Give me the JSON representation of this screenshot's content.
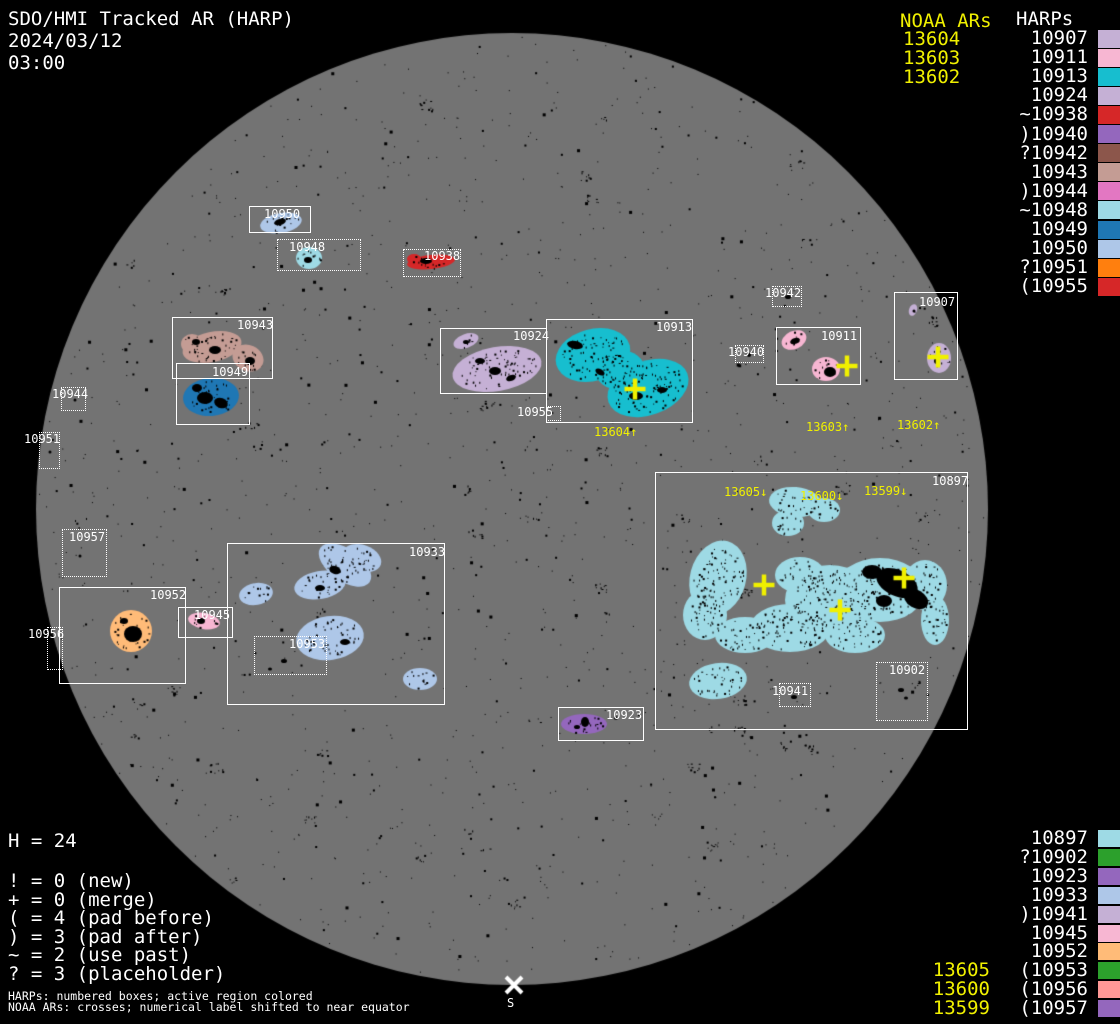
{
  "header": {
    "title": "SDO/HMI Tracked AR (HARP)",
    "date": "2024/03/12",
    "time": "03:00"
  },
  "colors": {
    "background": "#000000",
    "disk": "#737373",
    "yellow": "#f0f000",
    "white": "#ffffff"
  },
  "legend_top": {
    "noaa_title": "NOAA ARs",
    "harps_title": "HARPs",
    "noaa_items": [
      "13604",
      "13603",
      "13602"
    ],
    "harp_items": [
      {
        "label": "10907",
        "color": "#c5b0d5"
      },
      {
        "label": "10911",
        "color": "#f7b6d2"
      },
      {
        "label": "10913",
        "color": "#17becf"
      },
      {
        "label": "10924",
        "color": "#c5b0d5"
      },
      {
        "label": "~10938",
        "color": "#d62728"
      },
      {
        "label": ")10940",
        "color": "#9467bd"
      },
      {
        "label": "?10942",
        "color": "#8c564b"
      },
      {
        "label": "10943",
        "color": "#c49c94"
      },
      {
        "label": ")10944",
        "color": "#e377c2"
      },
      {
        "label": "~10948",
        "color": "#9edae5"
      },
      {
        "label": "10949",
        "color": "#1f77b4"
      },
      {
        "label": "10950",
        "color": "#aec7e8"
      },
      {
        "label": "?10951",
        "color": "#ff7f0e"
      },
      {
        "label": "(10955",
        "color": "#d62728"
      }
    ]
  },
  "legend_bottom": {
    "harp_items": [
      {
        "label": "10897",
        "color": "#9edae5",
        "noaa": ""
      },
      {
        "label": "?10902",
        "color": "#2ca02c",
        "noaa": ""
      },
      {
        "label": "10923",
        "color": "#9467bd",
        "noaa": ""
      },
      {
        "label": "10933",
        "color": "#aec7e8",
        "noaa": ""
      },
      {
        "label": ")10941",
        "color": "#c5b0d5",
        "noaa": ""
      },
      {
        "label": "10945",
        "color": "#f7b6d2",
        "noaa": ""
      },
      {
        "label": "10952",
        "color": "#ffbb78",
        "noaa": ""
      },
      {
        "label": "(10953",
        "color": "#2ca02c",
        "noaa": "13605"
      },
      {
        "label": "(10956",
        "color": "#ff9896",
        "noaa": "13600"
      },
      {
        "label": "(10957",
        "color": "#9467bd",
        "noaa": "13599"
      }
    ]
  },
  "stats": {
    "h_count": "H = 24",
    "flags": [
      "! = 0 (new)",
      "+ = 0 (merge)",
      "( = 4 (pad before)",
      ") = 3 (pad after)",
      "~ = 2 (use past)",
      "? = 3 (placeholder)"
    ]
  },
  "footnotes": [
    "HARPs: numbered boxes; active region colored",
    "NOAA ARs: crosses; numerical label shifted to near equator"
  ],
  "south_marker": {
    "symbol": "S",
    "x": 514,
    "y": 985
  },
  "disk": {
    "cx": 512,
    "cy": 509,
    "r": 476
  },
  "harp_boxes": [
    {
      "harp": "10950",
      "x": 249,
      "y": 206,
      "w": 62,
      "h": 27,
      "style": "solid",
      "label_x": 264,
      "label_y": 208
    },
    {
      "harp": "10948",
      "x": 277,
      "y": 239,
      "w": 84,
      "h": 32,
      "style": "dotted",
      "label_x": 289,
      "label_y": 241
    },
    {
      "harp": "10938",
      "x": 403,
      "y": 249,
      "w": 58,
      "h": 28,
      "style": "dotted",
      "label_x": 424,
      "label_y": 250
    },
    {
      "harp": "10943",
      "x": 172,
      "y": 317,
      "w": 101,
      "h": 62,
      "style": "solid",
      "label_x": 237,
      "label_y": 319
    },
    {
      "harp": "10949",
      "x": 176,
      "y": 363,
      "w": 74,
      "h": 62,
      "style": "solid",
      "label_x": 212,
      "label_y": 366
    },
    {
      "harp": "10944",
      "x": 61,
      "y": 387,
      "w": 25,
      "h": 24,
      "style": "dotted",
      "label_x": 52,
      "label_y": 388
    },
    {
      "harp": "10951",
      "x": 39,
      "y": 432,
      "w": 21,
      "h": 37,
      "style": "dotted",
      "label_x": 24,
      "label_y": 433
    },
    {
      "harp": "10942",
      "x": 772,
      "y": 286,
      "w": 30,
      "h": 21,
      "style": "dotted",
      "label_x": 765,
      "label_y": 287
    },
    {
      "harp": "10924",
      "x": 440,
      "y": 328,
      "w": 107,
      "h": 66,
      "style": "solid",
      "label_x": 513,
      "label_y": 330
    },
    {
      "harp": "10913",
      "x": 546,
      "y": 319,
      "w": 147,
      "h": 104,
      "style": "solid",
      "label_x": 656,
      "label_y": 321
    },
    {
      "harp": "10955",
      "x": 546,
      "y": 406,
      "w": 15,
      "h": 15,
      "style": "dotted",
      "label_x": 517,
      "label_y": 406
    },
    {
      "harp": "10940",
      "x": 735,
      "y": 345,
      "w": 29,
      "h": 18,
      "style": "dotted",
      "label_x": 728,
      "label_y": 346
    },
    {
      "harp": "10911",
      "x": 776,
      "y": 327,
      "w": 85,
      "h": 58,
      "style": "solid",
      "label_x": 821,
      "label_y": 330
    },
    {
      "harp": "10907",
      "x": 894,
      "y": 292,
      "w": 64,
      "h": 88,
      "style": "solid",
      "label_x": 919,
      "label_y": 296
    },
    {
      "harp": "10957",
      "x": 62,
      "y": 529,
      "w": 45,
      "h": 48,
      "style": "dotted",
      "label_x": 69,
      "label_y": 531
    },
    {
      "harp": "10952",
      "x": 59,
      "y": 587,
      "w": 127,
      "h": 97,
      "style": "solid",
      "label_x": 150,
      "label_y": 589
    },
    {
      "harp": "10945",
      "x": 178,
      "y": 607,
      "w": 55,
      "h": 31,
      "style": "solid",
      "label_x": 194,
      "label_y": 609
    },
    {
      "harp": "10956",
      "x": 47,
      "y": 627,
      "w": 16,
      "h": 43,
      "style": "dotted",
      "label_x": 28,
      "label_y": 628
    },
    {
      "harp": "10933",
      "x": 227,
      "y": 543,
      "w": 218,
      "h": 162,
      "style": "solid",
      "label_x": 409,
      "label_y": 546
    },
    {
      "harp": "10953",
      "x": 254,
      "y": 636,
      "w": 73,
      "h": 39,
      "style": "dotted",
      "label_x": 289,
      "label_y": 638
    },
    {
      "harp": "10923",
      "x": 558,
      "y": 707,
      "w": 86,
      "h": 34,
      "style": "solid",
      "label_x": 606,
      "label_y": 709
    },
    {
      "harp": "10897",
      "x": 655,
      "y": 472,
      "w": 313,
      "h": 258,
      "style": "solid",
      "label_x": 932,
      "label_y": 475
    },
    {
      "harp": "10941",
      "x": 779,
      "y": 683,
      "w": 32,
      "h": 24,
      "style": "dotted",
      "label_x": 772,
      "label_y": 685
    },
    {
      "harp": "10902",
      "x": 876,
      "y": 662,
      "w": 52,
      "h": 59,
      "style": "dotted",
      "label_x": 889,
      "label_y": 664
    }
  ],
  "noaa_labels": [
    {
      "text": "13604↑",
      "x": 594,
      "y": 426
    },
    {
      "text": "13603↑",
      "x": 806,
      "y": 421
    },
    {
      "text": "13602↑",
      "x": 897,
      "y": 419
    },
    {
      "text": "13605↓",
      "x": 724,
      "y": 486
    },
    {
      "text": "13600↓",
      "x": 800,
      "y": 490
    },
    {
      "text": "13599↓",
      "x": 864,
      "y": 485
    }
  ],
  "noaa_crosses": [
    {
      "x": 635,
      "y": 389
    },
    {
      "x": 847,
      "y": 366
    },
    {
      "x": 938,
      "y": 357
    },
    {
      "x": 764,
      "y": 585
    },
    {
      "x": 840,
      "y": 610
    },
    {
      "x": 904,
      "y": 578
    }
  ],
  "regions": [
    {
      "harp": "10950",
      "color": "#aec7e8",
      "ellipses": [
        {
          "cx": 281,
          "cy": 223,
          "rx": 21,
          "ry": 10,
          "rot": -10
        }
      ]
    },
    {
      "harp": "10948",
      "color": "#9edae5",
      "ellipses": [
        {
          "cx": 309,
          "cy": 258,
          "rx": 13,
          "ry": 11,
          "rot": 0
        }
      ]
    },
    {
      "harp": "10938",
      "color": "#d62728",
      "ellipses": [
        {
          "cx": 431,
          "cy": 262,
          "rx": 24,
          "ry": 7,
          "rot": -6
        },
        {
          "cx": 414,
          "cy": 259,
          "rx": 7,
          "ry": 5,
          "rot": 0
        }
      ]
    },
    {
      "harp": "10943",
      "color": "#c49c94",
      "ellipses": [
        {
          "cx": 212,
          "cy": 347,
          "rx": 30,
          "ry": 15,
          "rot": -12
        },
        {
          "cx": 248,
          "cy": 358,
          "rx": 16,
          "ry": 13,
          "rot": 25
        },
        {
          "cx": 192,
          "cy": 344,
          "rx": 11,
          "ry": 10,
          "rot": 0
        }
      ]
    },
    {
      "harp": "10949",
      "color": "#1f77b4",
      "ellipses": [
        {
          "cx": 211,
          "cy": 397,
          "rx": 28,
          "ry": 19,
          "rot": -5
        }
      ]
    },
    {
      "harp": "10924",
      "color": "#c5b0d5",
      "ellipses": [
        {
          "cx": 466,
          "cy": 341,
          "rx": 13,
          "ry": 7,
          "rot": -20
        },
        {
          "cx": 497,
          "cy": 369,
          "rx": 45,
          "ry": 22,
          "rot": -10
        }
      ]
    },
    {
      "harp": "10913",
      "color": "#17becf",
      "ellipses": [
        {
          "cx": 593,
          "cy": 355,
          "rx": 38,
          "ry": 26,
          "rot": -15
        },
        {
          "cx": 648,
          "cy": 388,
          "rx": 42,
          "ry": 27,
          "rot": -20
        },
        {
          "cx": 620,
          "cy": 370,
          "rx": 25,
          "ry": 20,
          "rot": 0
        }
      ]
    },
    {
      "harp": "10911",
      "color": "#f7b6d2",
      "ellipses": [
        {
          "cx": 794,
          "cy": 340,
          "rx": 13,
          "ry": 9,
          "rot": -25
        },
        {
          "cx": 826,
          "cy": 369,
          "rx": 14,
          "ry": 12,
          "rot": 0
        }
      ]
    },
    {
      "harp": "10907",
      "color": "#c5b0d5",
      "ellipses": [
        {
          "cx": 913,
          "cy": 310,
          "rx": 4,
          "ry": 6,
          "rot": 20
        },
        {
          "cx": 939,
          "cy": 358,
          "rx": 12,
          "ry": 15,
          "rot": 0
        }
      ]
    },
    {
      "harp": "10952",
      "color": "#ffbb78",
      "ellipses": [
        {
          "cx": 131,
          "cy": 631,
          "rx": 21,
          "ry": 21,
          "rot": 0
        }
      ]
    },
    {
      "harp": "10945",
      "color": "#f7b6d2",
      "ellipses": [
        {
          "cx": 204,
          "cy": 621,
          "rx": 16,
          "ry": 8,
          "rot": 10
        }
      ]
    },
    {
      "harp": "10933",
      "color": "#aec7e8",
      "ellipses": [
        {
          "cx": 256,
          "cy": 594,
          "rx": 17,
          "ry": 11,
          "rot": -10
        },
        {
          "cx": 345,
          "cy": 565,
          "rx": 30,
          "ry": 16,
          "rot": 35
        },
        {
          "cx": 320,
          "cy": 585,
          "rx": 26,
          "ry": 14,
          "rot": -10
        },
        {
          "cx": 362,
          "cy": 558,
          "rx": 20,
          "ry": 13,
          "rot": 20
        },
        {
          "cx": 330,
          "cy": 638,
          "rx": 34,
          "ry": 22,
          "rot": -8
        },
        {
          "cx": 420,
          "cy": 679,
          "rx": 17,
          "ry": 11,
          "rot": 0
        }
      ]
    },
    {
      "harp": "10923",
      "color": "#9467bd",
      "ellipses": [
        {
          "cx": 584,
          "cy": 724,
          "rx": 23,
          "ry": 10,
          "rot": 0
        }
      ]
    },
    {
      "harp": "10897",
      "color": "#9edae5",
      "ellipses": [
        {
          "cx": 795,
          "cy": 502,
          "rx": 26,
          "ry": 15,
          "rot": 5
        },
        {
          "cx": 788,
          "cy": 523,
          "rx": 16,
          "ry": 13,
          "rot": 0
        },
        {
          "cx": 824,
          "cy": 510,
          "rx": 16,
          "ry": 12,
          "rot": 0
        },
        {
          "cx": 718,
          "cy": 578,
          "rx": 28,
          "ry": 38,
          "rot": 15
        },
        {
          "cx": 705,
          "cy": 615,
          "rx": 22,
          "ry": 25,
          "rot": 0
        },
        {
          "cx": 745,
          "cy": 635,
          "rx": 30,
          "ry": 18,
          "rot": 0
        },
        {
          "cx": 790,
          "cy": 628,
          "rx": 40,
          "ry": 24,
          "rot": 0
        },
        {
          "cx": 800,
          "cy": 575,
          "rx": 25,
          "ry": 18,
          "rot": 0
        },
        {
          "cx": 830,
          "cy": 600,
          "rx": 45,
          "ry": 35,
          "rot": 0
        },
        {
          "cx": 880,
          "cy": 590,
          "rx": 45,
          "ry": 32,
          "rot": 0
        },
        {
          "cx": 855,
          "cy": 635,
          "rx": 30,
          "ry": 18,
          "rot": 0
        },
        {
          "cx": 925,
          "cy": 585,
          "rx": 22,
          "ry": 25,
          "rot": 0
        },
        {
          "cx": 935,
          "cy": 620,
          "rx": 14,
          "ry": 25,
          "rot": 0
        },
        {
          "cx": 718,
          "cy": 681,
          "rx": 29,
          "ry": 18,
          "rot": -8
        }
      ]
    }
  ],
  "dark_patches": [
    {
      "cx": 897,
      "cy": 583,
      "rx": 22,
      "ry": 13,
      "rot": 25
    },
    {
      "cx": 872,
      "cy": 572,
      "rx": 10,
      "ry": 7,
      "rot": 0
    },
    {
      "cx": 916,
      "cy": 599,
      "rx": 13,
      "ry": 9,
      "rot": 30
    },
    {
      "cx": 884,
      "cy": 601,
      "rx": 8,
      "ry": 6,
      "rot": 0
    },
    {
      "cx": 205,
      "cy": 398,
      "rx": 8,
      "ry": 6,
      "rot": 0
    },
    {
      "cx": 221,
      "cy": 403,
      "rx": 7,
      "ry": 5,
      "rot": 20
    },
    {
      "cx": 197,
      "cy": 388,
      "rx": 5,
      "ry": 4,
      "rot": 0
    },
    {
      "cx": 133,
      "cy": 634,
      "rx": 9,
      "ry": 8,
      "rot": 0
    },
    {
      "cx": 124,
      "cy": 621,
      "rx": 4,
      "ry": 3,
      "rot": 0
    },
    {
      "cx": 575,
      "cy": 345,
      "rx": 8,
      "ry": 4,
      "rot": 10
    },
    {
      "cx": 636,
      "cy": 396,
      "rx": 7,
      "ry": 4,
      "rot": 0
    },
    {
      "cx": 662,
      "cy": 390,
      "rx": 5,
      "ry": 3,
      "rot": 0
    },
    {
      "cx": 600,
      "cy": 372,
      "rx": 5,
      "ry": 3,
      "rot": 30
    },
    {
      "cx": 335,
      "cy": 570,
      "rx": 6,
      "ry": 4,
      "rot": 20
    },
    {
      "cx": 320,
      "cy": 588,
      "rx": 5,
      "ry": 3,
      "rot": 0
    },
    {
      "cx": 345,
      "cy": 642,
      "rx": 5,
      "ry": 3,
      "rot": 0
    },
    {
      "cx": 585,
      "cy": 722,
      "rx": 4,
      "ry": 5,
      "rot": 0
    },
    {
      "cx": 577,
      "cy": 727,
      "rx": 3,
      "ry": 2,
      "rot": 0
    },
    {
      "cx": 215,
      "cy": 350,
      "rx": 6,
      "ry": 4,
      "rot": 0
    },
    {
      "cx": 250,
      "cy": 361,
      "rx": 5,
      "ry": 4,
      "rot": 0
    },
    {
      "cx": 196,
      "cy": 342,
      "rx": 4,
      "ry": 3,
      "rot": 0
    },
    {
      "cx": 426,
      "cy": 261,
      "rx": 6,
      "ry": 3,
      "rot": 0
    },
    {
      "cx": 280,
      "cy": 222,
      "rx": 6,
      "ry": 3,
      "rot": -15
    },
    {
      "cx": 830,
      "cy": 372,
      "rx": 6,
      "ry": 5,
      "rot": 0
    },
    {
      "cx": 795,
      "cy": 341,
      "rx": 5,
      "ry": 3,
      "rot": -20
    },
    {
      "cx": 937,
      "cy": 361,
      "rx": 3,
      "ry": 3,
      "rot": 0
    },
    {
      "cx": 495,
      "cy": 371,
      "rx": 6,
      "ry": 4,
      "rot": 0
    },
    {
      "cx": 480,
      "cy": 361,
      "rx": 5,
      "ry": 3,
      "rot": 0
    },
    {
      "cx": 511,
      "cy": 378,
      "rx": 5,
      "ry": 3,
      "rot": -20
    },
    {
      "cx": 466,
      "cy": 342,
      "rx": 3,
      "ry": 2,
      "rot": 0
    },
    {
      "cx": 201,
      "cy": 621,
      "rx": 4,
      "ry": 3,
      "rot": 0
    },
    {
      "cx": 308,
      "cy": 260,
      "rx": 4,
      "ry": 3,
      "rot": 0
    },
    {
      "cx": 788,
      "cy": 297,
      "rx": 3,
      "ry": 2,
      "rot": 0
    },
    {
      "cx": 749,
      "cy": 355,
      "rx": 2,
      "ry": 2,
      "rot": 0
    },
    {
      "cx": 794,
      "cy": 697,
      "rx": 3,
      "ry": 2,
      "rot": 0
    },
    {
      "cx": 901,
      "cy": 690,
      "rx": 3,
      "ry": 2,
      "rot": 0
    },
    {
      "cx": 906,
      "cy": 698,
      "rx": 2,
      "ry": 1.5,
      "rot": 0
    },
    {
      "cx": 284,
      "cy": 661,
      "rx": 3,
      "ry": 2,
      "rot": 0
    },
    {
      "cx": 270,
      "cy": 669,
      "rx": 2,
      "ry": 1.5,
      "rot": 0
    },
    {
      "cx": 50,
      "cy": 452,
      "rx": 1.5,
      "ry": 1.5,
      "rot": 0
    },
    {
      "cx": 75,
      "cy": 400,
      "rx": 1.5,
      "ry": 1.5,
      "rot": 0
    },
    {
      "cx": 552,
      "cy": 413,
      "rx": 1.5,
      "ry": 1,
      "rot": 0
    },
    {
      "cx": 55,
      "cy": 648,
      "rx": 1.5,
      "ry": 1.5,
      "rot": 0
    },
    {
      "cx": 80,
      "cy": 556,
      "rx": 1.5,
      "ry": 1.5,
      "rot": 0
    },
    {
      "cx": 914,
      "cy": 311,
      "rx": 1.5,
      "ry": 1.5,
      "rot": 0
    }
  ],
  "chart_data": {
    "type": "scatter",
    "title": "SDO/HMI Tracked AR (HARP)",
    "subtitle": "2024/03/12 03:00",
    "harp_total": 24,
    "harps_on_disk": [
      "10897",
      "10902",
      "10907",
      "10911",
      "10913",
      "10923",
      "10924",
      "10933",
      "10938",
      "10940",
      "10941",
      "10942",
      "10943",
      "10944",
      "10945",
      "10948",
      "10949",
      "10950",
      "10951",
      "10952",
      "10953",
      "10955",
      "10956",
      "10957"
    ],
    "noaa_ars": [
      "13599",
      "13600",
      "13602",
      "13603",
      "13604",
      "13605"
    ],
    "flag_counts": {
      "new": 0,
      "merge": 0,
      "pad_before": 4,
      "pad_after": 3,
      "use_past": 2,
      "placeholder": 3
    },
    "notes": [
      "HARPs: numbered boxes; active region colored",
      "NOAA ARs: crosses; numerical label shifted to near equator"
    ]
  }
}
